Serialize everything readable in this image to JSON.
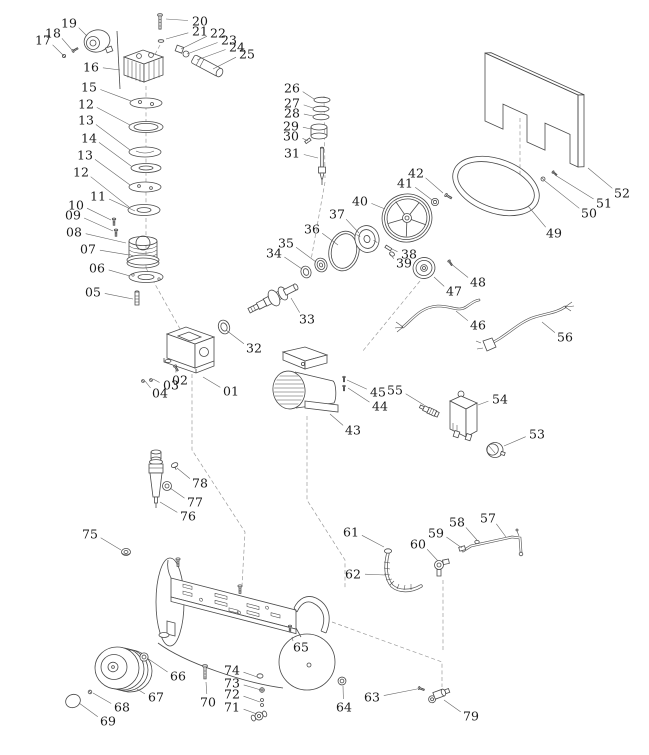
{
  "diagram": {
    "type": "exploded-parts-diagram",
    "colors": {
      "background": "#ffffff",
      "line": "#4a4a4a",
      "dash": "#9a9a9a",
      "leader": "#666666",
      "label": "#1b1b1b",
      "mesh": "#8c8c8c"
    },
    "label_font_size": 12.5,
    "parts": [
      {
        "n": "19",
        "x": 69,
        "y": 23,
        "tx": 87,
        "ty": 36
      },
      {
        "n": "18",
        "x": 53,
        "y": 33,
        "tx": 72,
        "ty": 50
      },
      {
        "n": "17",
        "x": 43,
        "y": 40,
        "tx": 63,
        "ty": 55
      },
      {
        "n": "20",
        "x": 200,
        "y": 21,
        "tx": 166,
        "ty": 19
      },
      {
        "n": "21",
        "x": 200,
        "y": 31,
        "tx": 166,
        "ty": 39
      },
      {
        "n": "22",
        "x": 218,
        "y": 33,
        "tx": 181,
        "ty": 49
      },
      {
        "n": "23",
        "x": 229,
        "y": 40,
        "tx": 187,
        "ty": 54
      },
      {
        "n": "24",
        "x": 237,
        "y": 47,
        "tx": 197,
        "ty": 60
      },
      {
        "n": "25",
        "x": 247,
        "y": 54,
        "tx": 213,
        "ty": 69
      },
      {
        "n": "16",
        "x": 91,
        "y": 67,
        "tx": 120,
        "ty": 70
      },
      {
        "n": "15",
        "x": 89,
        "y": 87,
        "tx": 131,
        "ty": 101
      },
      {
        "n": "12",
        "x": 86,
        "y": 104,
        "tx": 130,
        "ty": 125
      },
      {
        "n": "13",
        "x": 86,
        "y": 120,
        "tx": 130,
        "ty": 150
      },
      {
        "n": "14",
        "x": 89,
        "y": 138,
        "tx": 131,
        "ty": 166
      },
      {
        "n": "13",
        "x": 85,
        "y": 155,
        "tx": 130,
        "ty": 185
      },
      {
        "n": "12",
        "x": 81,
        "y": 172,
        "tx": 129,
        "ty": 207
      },
      {
        "n": "11",
        "x": 98,
        "y": 196,
        "tx": 135,
        "ty": 211
      },
      {
        "n": "10",
        "x": 76,
        "y": 205,
        "tx": 111,
        "ty": 220
      },
      {
        "n": "09",
        "x": 73,
        "y": 215,
        "tx": 113,
        "ty": 231
      },
      {
        "n": "08",
        "x": 74,
        "y": 232,
        "tx": 126,
        "ty": 243
      },
      {
        "n": "07",
        "x": 88,
        "y": 249,
        "tx": 129,
        "ty": 255
      },
      {
        "n": "06",
        "x": 97,
        "y": 268,
        "tx": 130,
        "ty": 276
      },
      {
        "n": "05",
        "x": 93,
        "y": 292,
        "tx": 133,
        "ty": 299
      },
      {
        "n": "26",
        "x": 292,
        "y": 88,
        "tx": 314,
        "ty": 99
      },
      {
        "n": "27",
        "x": 292,
        "y": 103,
        "tx": 313,
        "ty": 108
      },
      {
        "n": "28",
        "x": 292,
        "y": 113,
        "tx": 313,
        "ty": 116
      },
      {
        "n": "29",
        "x": 291,
        "y": 126,
        "tx": 311,
        "ty": 129
      },
      {
        "n": "30",
        "x": 291,
        "y": 136,
        "tx": 308,
        "ty": 141
      },
      {
        "n": "31",
        "x": 292,
        "y": 153,
        "tx": 318,
        "ty": 158
      },
      {
        "n": "32",
        "x": 254,
        "y": 348,
        "tx": 226,
        "ty": 330
      },
      {
        "n": "33",
        "x": 307,
        "y": 319,
        "tx": 291,
        "ty": 298
      },
      {
        "n": "34",
        "x": 274,
        "y": 253,
        "tx": 302,
        "ty": 269
      },
      {
        "n": "35",
        "x": 286,
        "y": 243,
        "tx": 316,
        "ty": 262
      },
      {
        "n": "36",
        "x": 312,
        "y": 229,
        "tx": 338,
        "ty": 245
      },
      {
        "n": "37",
        "x": 337,
        "y": 214,
        "tx": 359,
        "ty": 233
      },
      {
        "n": "38",
        "x": 409,
        "y": 254,
        "tx": 392,
        "ty": 249
      },
      {
        "n": "39",
        "x": 404,
        "y": 263,
        "tx": 390,
        "ty": 254
      },
      {
        "n": "40",
        "x": 360,
        "y": 201,
        "tx": 385,
        "ty": 209
      },
      {
        "n": "41",
        "x": 405,
        "y": 183,
        "tx": 432,
        "ty": 200
      },
      {
        "n": "42",
        "x": 416,
        "y": 173,
        "tx": 443,
        "ty": 193
      },
      {
        "n": "43",
        "x": 353,
        "y": 430,
        "tx": 330,
        "ty": 414
      },
      {
        "n": "44",
        "x": 380,
        "y": 406,
        "tx": 348,
        "ty": 388
      },
      {
        "n": "45",
        "x": 378,
        "y": 392,
        "tx": 347,
        "ty": 380
      },
      {
        "n": "55",
        "x": 395,
        "y": 390,
        "tx": 424,
        "ty": 405
      },
      {
        "n": "46",
        "x": 478,
        "y": 325,
        "tx": 456,
        "ty": 311
      },
      {
        "n": "47",
        "x": 454,
        "y": 291,
        "tx": 434,
        "ty": 277
      },
      {
        "n": "48",
        "x": 478,
        "y": 282,
        "tx": 450,
        "ty": 263
      },
      {
        "n": "49",
        "x": 554,
        "y": 233,
        "tx": 528,
        "ty": 206
      },
      {
        "n": "50",
        "x": 589,
        "y": 213,
        "tx": 545,
        "ty": 181
      },
      {
        "n": "51",
        "x": 604,
        "y": 203,
        "tx": 555,
        "ty": 175
      },
      {
        "n": "52",
        "x": 622,
        "y": 193,
        "tx": 588,
        "ty": 168
      },
      {
        "n": "53",
        "x": 537,
        "y": 434,
        "tx": 504,
        "ty": 446
      },
      {
        "n": "54",
        "x": 500,
        "y": 399,
        "tx": 478,
        "ty": 405
      },
      {
        "n": "56",
        "x": 565,
        "y": 337,
        "tx": 542,
        "ty": 322
      },
      {
        "n": "57",
        "x": 488,
        "y": 518,
        "tx": 506,
        "ty": 537
      },
      {
        "n": "58",
        "x": 457,
        "y": 522,
        "tx": 477,
        "ty": 540
      },
      {
        "n": "59",
        "x": 436,
        "y": 533,
        "tx": 462,
        "ty": 548
      },
      {
        "n": "60",
        "x": 418,
        "y": 544,
        "tx": 438,
        "ty": 561
      },
      {
        "n": "61",
        "x": 351,
        "y": 532,
        "tx": 384,
        "ty": 547
      },
      {
        "n": "62",
        "x": 353,
        "y": 574,
        "tx": 385,
        "ty": 575
      },
      {
        "n": "63",
        "x": 372,
        "y": 697,
        "tx": 417,
        "ty": 689
      },
      {
        "n": "64",
        "x": 344,
        "y": 707,
        "tx": 343,
        "ty": 686
      },
      {
        "n": "65",
        "x": 301,
        "y": 647,
        "tx": 292,
        "ty": 637
      },
      {
        "n": "66",
        "x": 178,
        "y": 676,
        "tx": 147,
        "ty": 658
      },
      {
        "n": "67",
        "x": 156,
        "y": 697,
        "tx": 137,
        "ty": 689
      },
      {
        "n": "68",
        "x": 122,
        "y": 707,
        "tx": 93,
        "ty": 693
      },
      {
        "n": "69",
        "x": 108,
        "y": 721,
        "tx": 79,
        "ty": 703
      },
      {
        "n": "70",
        "x": 208,
        "y": 702,
        "tx": 206,
        "ty": 682
      },
      {
        "n": "71",
        "x": 232,
        "y": 707,
        "tx": 257,
        "ty": 714
      },
      {
        "n": "72",
        "x": 232,
        "y": 694,
        "tx": 260,
        "ty": 702
      },
      {
        "n": "73",
        "x": 232,
        "y": 683,
        "tx": 261,
        "ty": 690
      },
      {
        "n": "74",
        "x": 232,
        "y": 670,
        "tx": 260,
        "ty": 678
      },
      {
        "n": "75",
        "x": 90,
        "y": 534,
        "tx": 121,
        "ty": 550
      },
      {
        "n": "76",
        "x": 188,
        "y": 516,
        "tx": 160,
        "ty": 502
      },
      {
        "n": "77",
        "x": 195,
        "y": 502,
        "tx": 170,
        "ty": 488
      },
      {
        "n": "78",
        "x": 200,
        "y": 483,
        "tx": 177,
        "ty": 468
      },
      {
        "n": "79",
        "x": 471,
        "y": 716,
        "tx": 444,
        "ty": 700
      },
      {
        "n": "01",
        "x": 231,
        "y": 391,
        "tx": 203,
        "ty": 377
      },
      {
        "n": "02",
        "x": 180,
        "y": 380,
        "tx": 176,
        "ty": 369
      },
      {
        "n": "03",
        "x": 171,
        "y": 385,
        "tx": 153,
        "ty": 379
      },
      {
        "n": "04",
        "x": 160,
        "y": 393,
        "tx": 145,
        "ty": 381
      }
    ]
  }
}
